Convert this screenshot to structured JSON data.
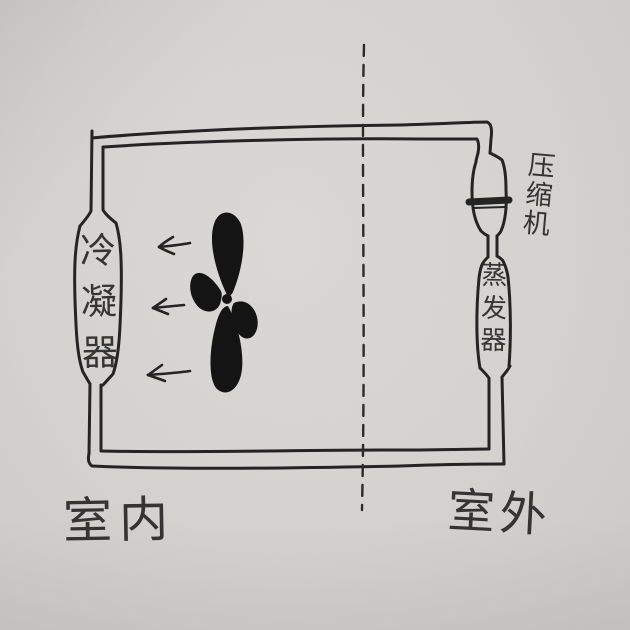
{
  "labels": {
    "condenser": "冷凝器",
    "compressor": "压缩机",
    "evaporator": "蒸发器",
    "region_indoor": "室内",
    "region_outdoor": "室外"
  },
  "icons": {
    "fan": "fan-propeller-icon",
    "airflow_arrow": "left-arrow-icon",
    "airflow_arrow_count": 3,
    "partition": "dashed-partition-line"
  },
  "colors": {
    "paper": "#d5d3cf",
    "ink": "#242424"
  }
}
